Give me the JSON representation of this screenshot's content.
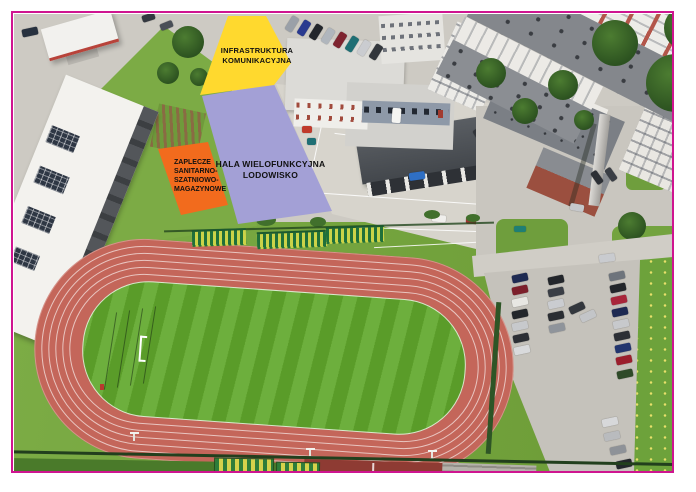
{
  "frame": {
    "color": "#cf1590"
  },
  "overlays": {
    "infrastruktura": {
      "line1": "INFRASTRUKTURA",
      "line2": "KOMUNIKACYJNA",
      "color": "#ffd92e"
    },
    "hala": {
      "line1": "HALA WIELOFUNKCYJNA",
      "line2": "LODOWISKO",
      "color": "#a3a0d6"
    },
    "zaplecze": {
      "lines": [
        "ZAPLECZE",
        "SANITARNO-",
        "SZATNIOWO-",
        "MAGAZYNOWE"
      ],
      "color": "#f26b1d"
    }
  },
  "scene": {
    "track_color": "#c4665a",
    "field_color": "#61a82c",
    "grass_color": "#74a73a"
  }
}
